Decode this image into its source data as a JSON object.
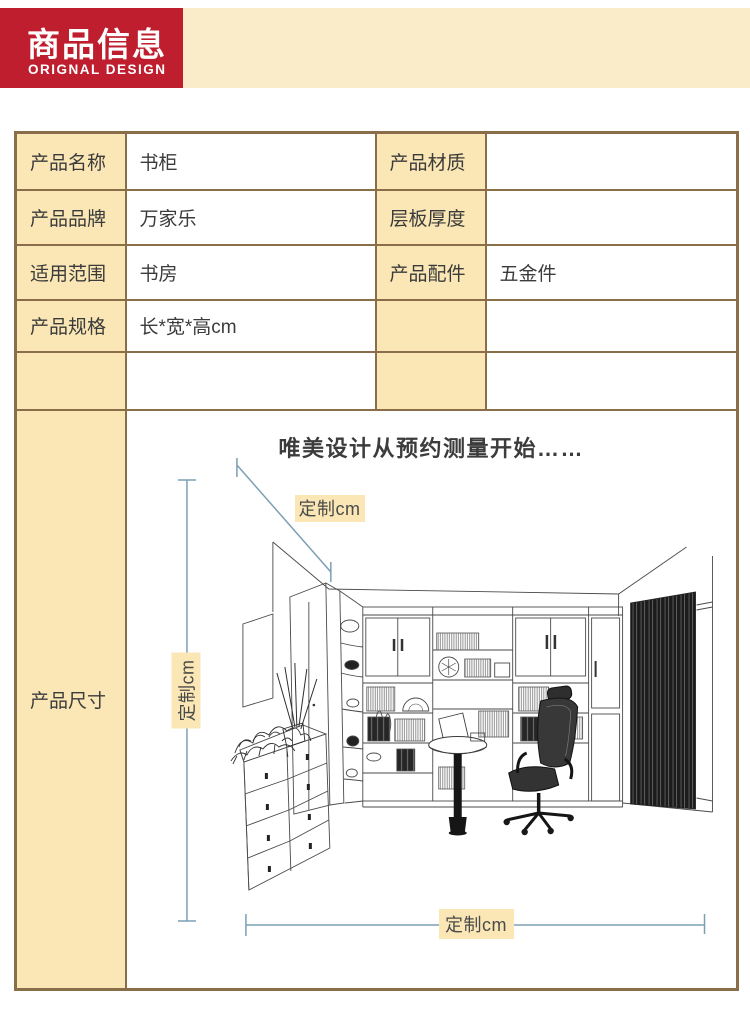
{
  "header": {
    "title": "商品信息",
    "subtitle": "ORIGNAL DESIGN"
  },
  "table": {
    "rows": [
      {
        "label_left": "产品名称",
        "value_left": "书柜",
        "label_right": "产品材质",
        "value_right": ""
      },
      {
        "label_left": "产品品牌",
        "value_left": "万家乐",
        "label_right": "层板厚度",
        "value_right": ""
      },
      {
        "label_left": "适用范围",
        "value_left": "书房",
        "label_right": "产品配件",
        "value_right": "五金件"
      },
      {
        "label_left": "产品规格",
        "value_left": "长*宽*高cm",
        "label_right": "",
        "value_right": ""
      },
      {
        "label_left": "",
        "value_left": "",
        "label_right": "",
        "value_right": ""
      }
    ],
    "dimension_row_label": "产品尺寸"
  },
  "figure": {
    "caption": "唯美设计从预约测量开始……",
    "dim_label_diagonal": "定制cm",
    "dim_label_vertical": "定制cm",
    "dim_label_horizontal": "定制cm"
  },
  "colors": {
    "brand_red": "#BE1E2D",
    "cream_band": "#FBECC9",
    "cell_tan": "#FAE7B5",
    "table_border": "#8A6E4A",
    "dimension_line": "#7C9FB5"
  }
}
